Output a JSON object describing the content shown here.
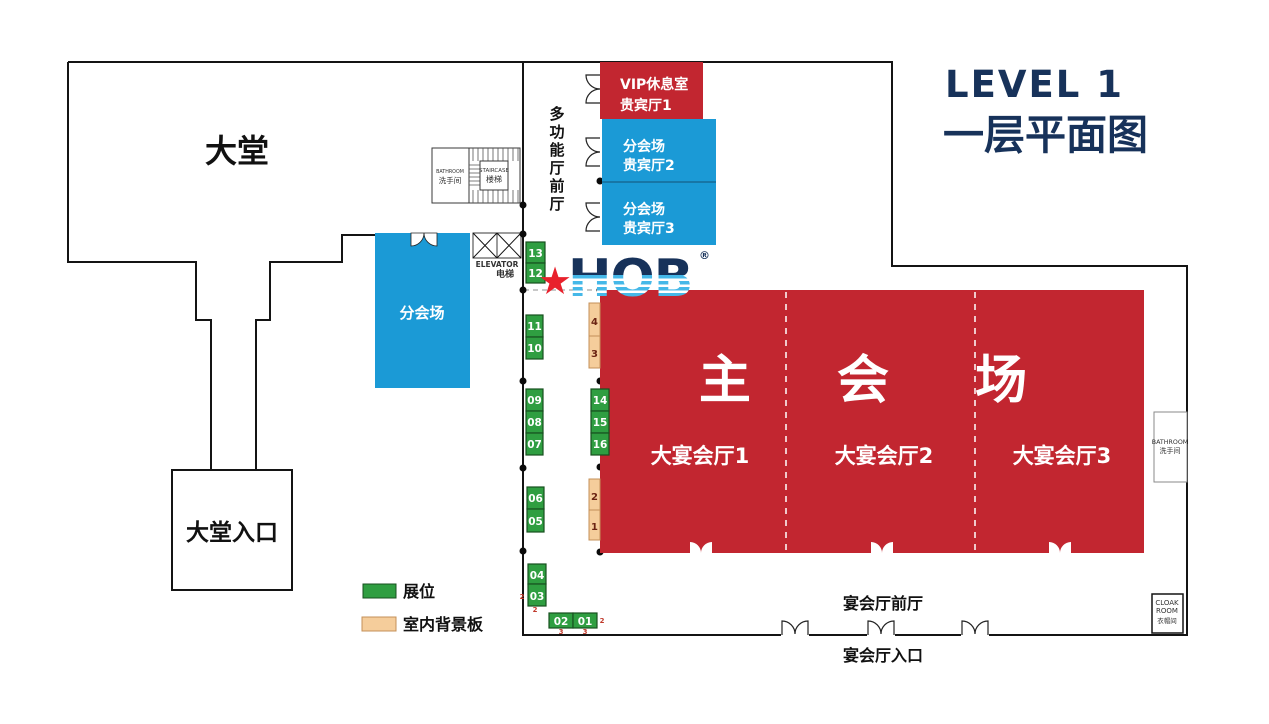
{
  "title": {
    "level": "LEVEL 1",
    "floor": "一层平面图"
  },
  "logo": {
    "brand": "HOB",
    "registered": "®",
    "star": "★"
  },
  "areas": {
    "lobby": "大堂",
    "lobby_entrance": "大堂入口",
    "foyer_vertical_chars": [
      "多",
      "功",
      "能",
      "厅",
      "前",
      "厅"
    ],
    "breakout_left": "分会场",
    "vip1": {
      "line1": "VIP休息室",
      "line2": "贵宾厅1"
    },
    "vip2": {
      "line1": "分会场",
      "line2": "贵宾厅2"
    },
    "vip3": {
      "line1": "分会场",
      "line2": "贵宾厅3"
    },
    "main_hall": {
      "title": "主 会 场",
      "hall1": "大宴会厅1",
      "hall2": "大宴会厅2",
      "hall3": "大宴会厅3"
    },
    "banquet_foyer": "宴会厅前厅",
    "banquet_entrance": "宴会厅入口"
  },
  "facilities": {
    "staircase_en": "STAIRCASE",
    "staircase_zh": "楼梯",
    "bathroom_small_en": "BATHROOM",
    "bathroom_small_zh": "洗手间",
    "elevator_en": "ELEVATOR",
    "elevator_zh": "电梯",
    "bathroom_en": "BATHROOM",
    "bathroom_zh": "洗手间",
    "cloak_en1": "CLOAK",
    "cloak_en2": "ROOM",
    "cloak_zh": "衣帽间"
  },
  "legend": {
    "booth": "展位",
    "backdrop": "室内背景板"
  },
  "booths": {
    "b13": "13",
    "b12": "12",
    "b11": "11",
    "b10": "10",
    "b09": "09",
    "b08": "08",
    "b07": "07",
    "b06": "06",
    "b05": "05",
    "b04": "04",
    "b03": "03",
    "b02": "02",
    "b01": "01",
    "b14": "14",
    "b15": "15",
    "b16": "16"
  },
  "backdrops": {
    "d4": "4",
    "d3": "3",
    "d2": "2",
    "d1": "1"
  },
  "dims": {
    "a": "2",
    "b": "2",
    "c": "3",
    "d": "3",
    "e": "2"
  },
  "colors": {
    "hall_red": "#c22630",
    "room_blue": "#1b9ad6",
    "booth_green": "#2f9e41",
    "backdrop_tan": "#f5cd9b",
    "title_navy": "#17325a",
    "logo_stripe_blue": "#45b8e8",
    "star_red": "#e8212c"
  }
}
